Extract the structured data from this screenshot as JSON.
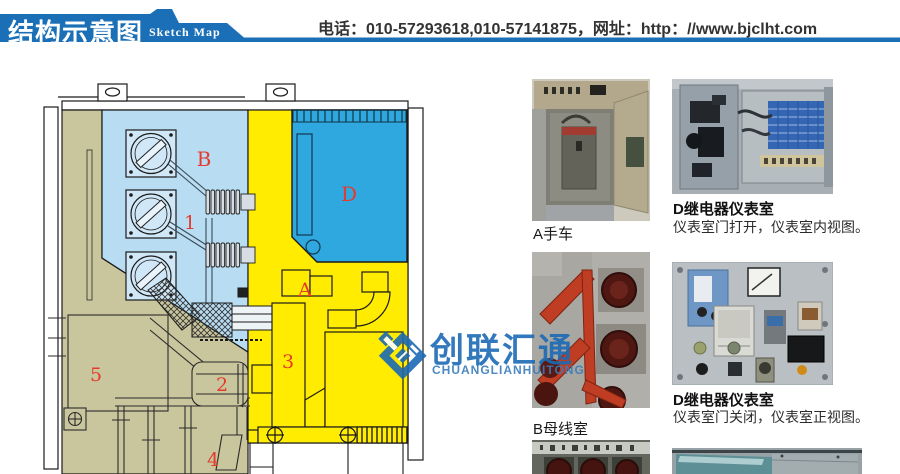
{
  "header": {
    "title_cn": "结构示意图",
    "title_en": "Sketch Map",
    "contact": "电话：010-57293618,010-57141875，网址：http：//www.bjclht.com",
    "banner_color": "#1a6fb6"
  },
  "diagram": {
    "description": "switchgear-cabinet-cross-section",
    "colors": {
      "busbar_room_b": "#b8dcf2",
      "instrument_room_d": "#2fa7df",
      "breaker_room_a": "#ffec00",
      "cable_room": "#c9c59d",
      "label_red": "#e43b2c",
      "line": "#1a1a1a"
    },
    "labels": [
      {
        "text": "B"
      },
      {
        "text": "1"
      },
      {
        "text": "D"
      },
      {
        "text": "A"
      },
      {
        "text": "3"
      },
      {
        "text": "5"
      },
      {
        "text": "2"
      },
      {
        "text": "4"
      }
    ]
  },
  "watermark": {
    "cn": "创联汇通",
    "en": "CHUANGLIANHUITONG",
    "color": "#1b6ab5"
  },
  "photos": [
    {
      "caption": "A手车",
      "desc": ""
    },
    {
      "caption": "D继电器仪表室",
      "desc": "仪表室门打开，仪表室内视图。"
    },
    {
      "caption": "B母线室",
      "desc": ""
    },
    {
      "caption": "D继电器仪表室",
      "desc": "仪表室门关闭，仪表室正视图。"
    }
  ]
}
